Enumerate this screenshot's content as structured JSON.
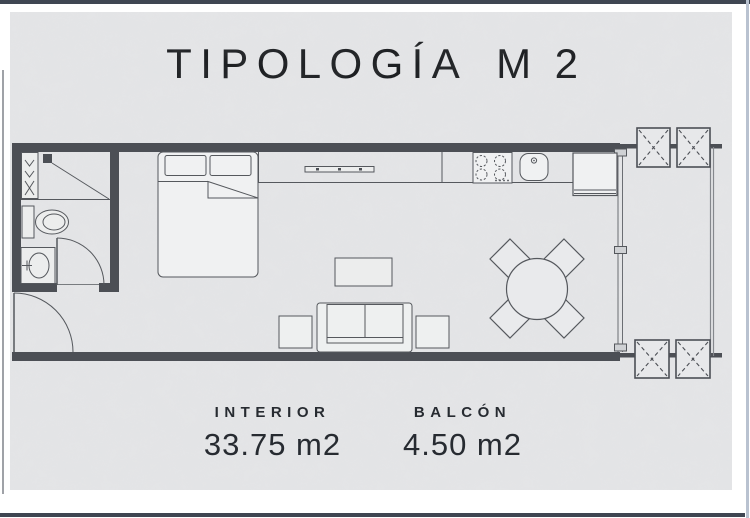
{
  "title": {
    "main": "TIPOLOGÍA",
    "code": "M 2"
  },
  "areas": {
    "interior": {
      "label": "INTERIOR",
      "value": "33.75 m2"
    },
    "balcony": {
      "label": "BALCÓN",
      "value": "4.50 m2"
    }
  },
  "colors": {
    "frame": "#3f4652",
    "panel_background": "#e4e5e7",
    "wall": "#4c4f55",
    "furniture_line": "#55585d",
    "text": "#272b31"
  },
  "plan": {
    "name": "studio-apartment-floor-plan",
    "furniture": [
      "wardrobe",
      "shower",
      "toilet",
      "sink-vanity",
      "bathroom-door",
      "entry-door",
      "double-bed",
      "kitchen-counter",
      "counter-shelf",
      "stove",
      "kitchen-sink",
      "refrigerator",
      "window-wall",
      "coffee-table",
      "sofa",
      "side-table-left",
      "side-table-right",
      "dining-table",
      "dining-chairs",
      "ac-units",
      "balcony"
    ]
  }
}
